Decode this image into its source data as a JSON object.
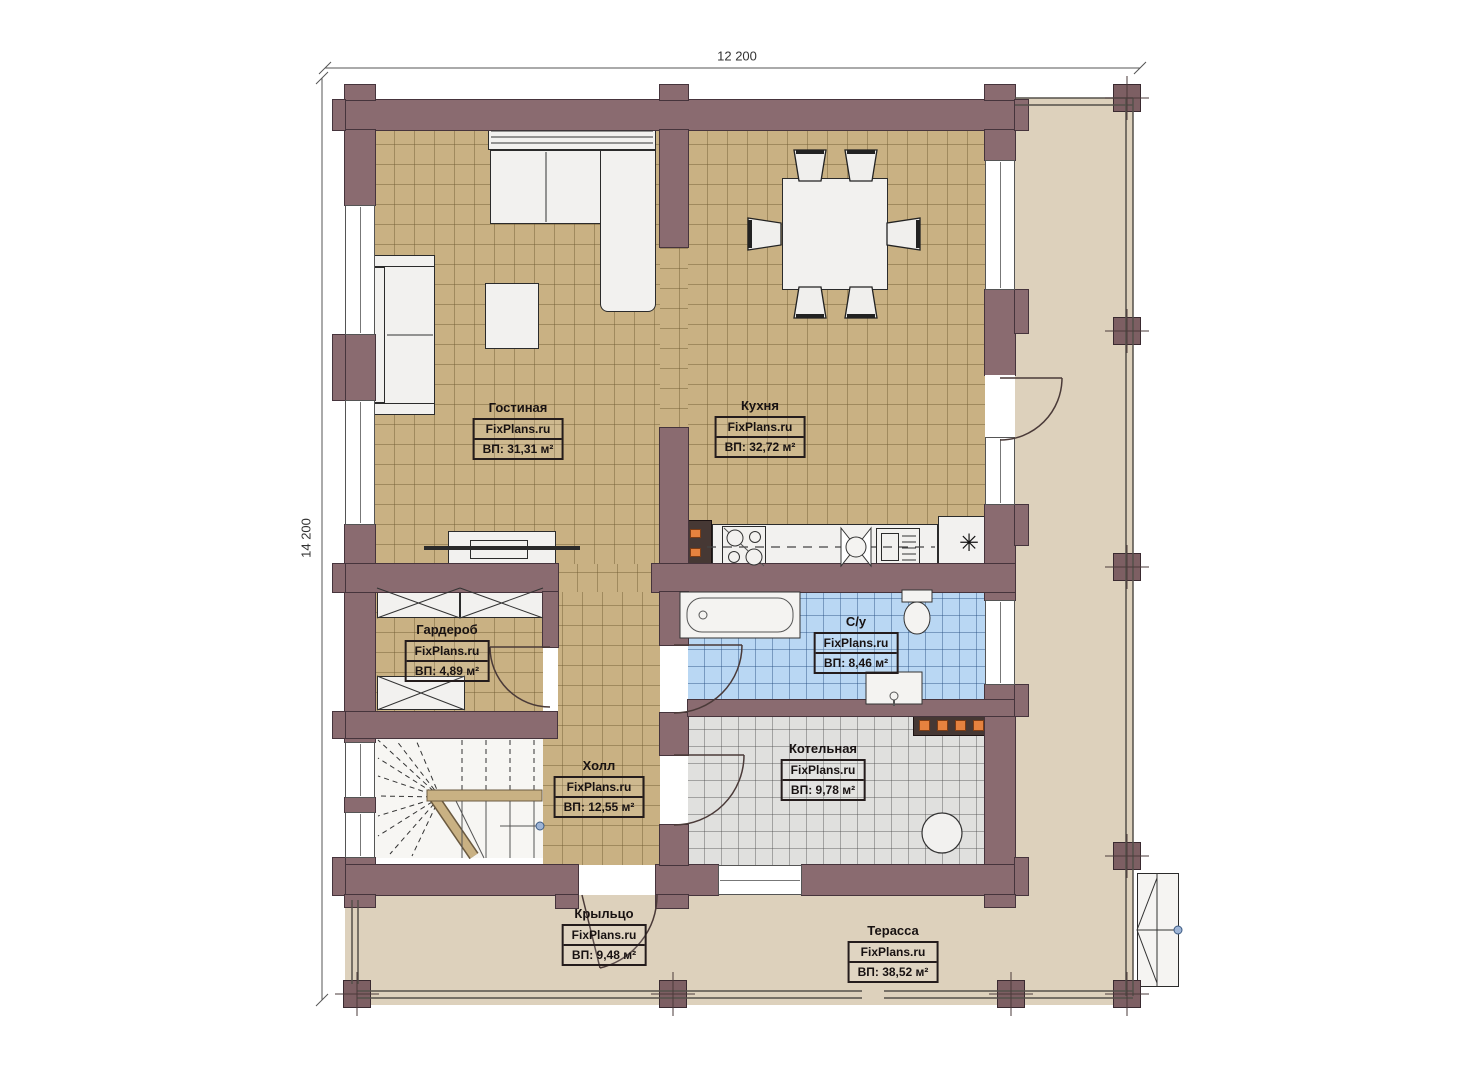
{
  "watermark": "FixPlans.ru",
  "dimensions": {
    "top": "12 200",
    "left": "14 200"
  },
  "rooms": [
    {
      "name": "Гостиная",
      "area": "ВП: 31,31 м²"
    },
    {
      "name": "Кухня",
      "area": "ВП: 32,72 м²"
    },
    {
      "name": "Гардероб",
      "area": "ВП: 4,89 м²"
    },
    {
      "name": "С/у",
      "area": "ВП: 8,46 м²"
    },
    {
      "name": "Котельная",
      "area": "ВП: 9,78 м²"
    },
    {
      "name": "Холл",
      "area": "ВП: 12,55 м²"
    },
    {
      "name": "Крыльцо",
      "area": "ВП: 9,48 м²"
    },
    {
      "name": "Терасса",
      "area": "ВП: 38,52 м²"
    }
  ],
  "icons": {
    "fridge": "✳"
  },
  "colors": {
    "wall": "#8a6b70",
    "floor_tile": "#c9b183",
    "bathroom_tile": "#b9d7f3",
    "boiler_floor": "#e0e0de",
    "terrace_floor": "#ddd1bc",
    "accent_orange": "#e5823f"
  }
}
